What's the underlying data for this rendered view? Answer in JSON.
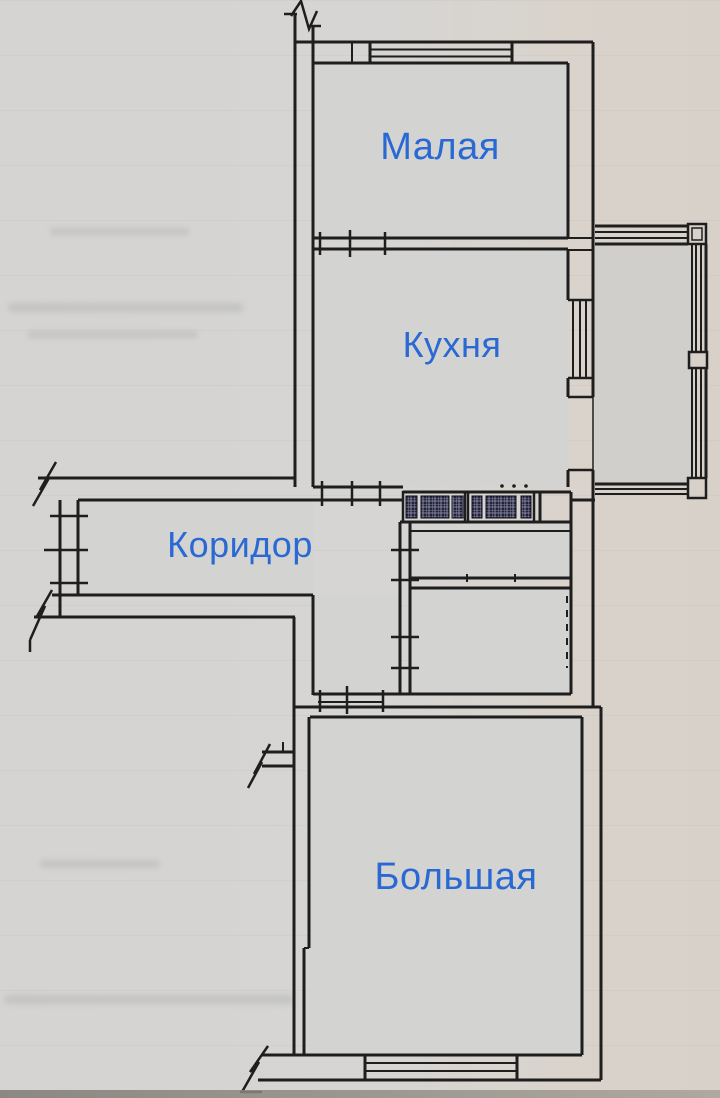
{
  "document_kind": "scanned apartment floor plan",
  "colors": {
    "label_blue": "#2a69d4",
    "wall": "#1e1e1e",
    "paper": "#d6d4d1",
    "room_fill": "#d3d3d1",
    "balcony_fill": "#d0cfcc",
    "vent_dark": "#22223a",
    "vent_grid": "#9a9ab2"
  },
  "rooms": [
    {
      "id": "malaya",
      "label": "Малая"
    },
    {
      "id": "kuhnya",
      "label": "Кухня"
    },
    {
      "id": "koridor",
      "label": "Коридор"
    },
    {
      "id": "bolshaya",
      "label": "Большая"
    }
  ],
  "unlabeled_features": [
    "glazed-balcony",
    "wc",
    "bathroom",
    "inner-hall",
    "ventilation-shafts",
    "windows",
    "entrance-opening",
    "wall-break-marks"
  ]
}
